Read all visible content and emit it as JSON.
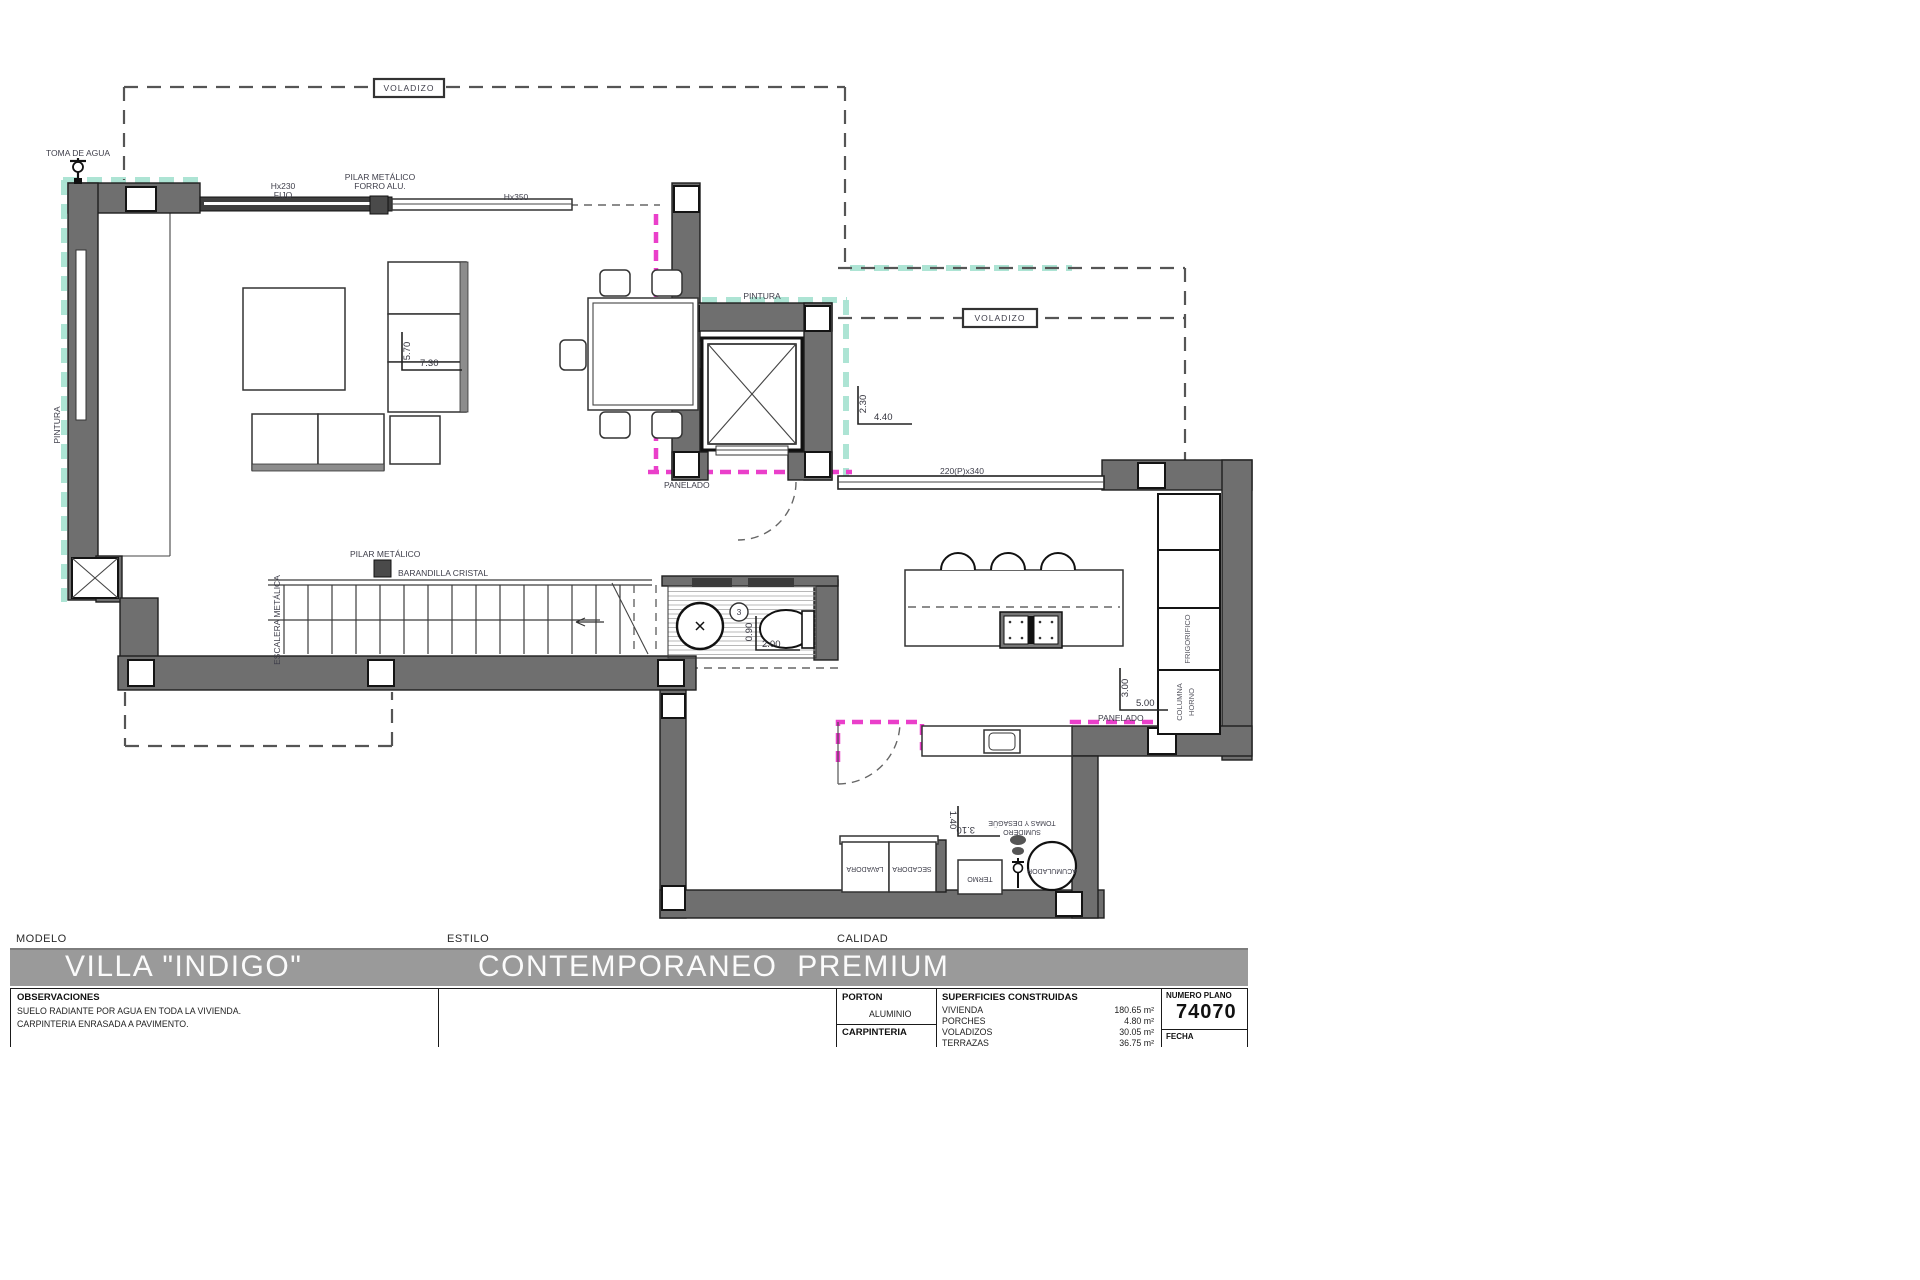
{
  "plan": {
    "annotations": {
      "toma_de_agua": "TOMA DE AGUA",
      "voladizo": "VOLADIZO",
      "hx230": "Hx230",
      "fijo": "FIJO",
      "pilar_metalico": "PILAR METÁLICO",
      "forro_alu": "FORRO ALU.",
      "hx350": "Hx350",
      "pintura": "PINTURA",
      "panelado": "PANELADO",
      "barandilla": "BARANDILLA CRISTAL",
      "escalera": "ESCALERA METÁLICA",
      "frigorifico": "FRIGORIFICO",
      "columna": "COLUMNA",
      "horno": "HORNO",
      "lavadora": "LAVADORA",
      "secadora": "SECADORA",
      "termo": "TERMO",
      "tomas_desague": "TOMAS Y DESAGÜE",
      "sumidero": "SUMIDERO",
      "acumulador": "ACUMULADOR"
    },
    "dimensions": {
      "living_v": "5.70",
      "living_h": "7.30",
      "elevator_v": "2.30",
      "elevator_h": "4.40",
      "kitchen_v": "3.00",
      "kitchen_h": "5.00",
      "bath_v": "0.90",
      "bath_h": "2.00",
      "laundry_v": "1.40",
      "laundry_h": "3.10",
      "window": "220(P)x340",
      "bath_number": "3"
    },
    "colors": {
      "wall": "#6f6f6f",
      "pintura_highlight": "#a9e3d2",
      "panelado_highlight": "#ea3fca",
      "titlebar": "#9a9a9a"
    }
  },
  "titleblock": {
    "modelo_label": "MODELO",
    "modelo": "VILLA \"INDIGO\"",
    "estilo_label": "ESTILO",
    "estilo": "CONTEMPORANEO  PREMIUM",
    "calidad_label": "CALIDAD",
    "observaciones_label": "OBSERVACIONES",
    "observaciones_1": "SUELO RADIANTE POR AGUA EN TODA LA VIVIENDA.",
    "observaciones_2": "CARPINTERIA ENRASADA A PAVIMENTO.",
    "porton_label": "PORTON",
    "porton_value": "ALUMINIO",
    "carpinteria_label": "CARPINTERIA",
    "superficies_label": "SUPERFICIES CONSTRUIDAS",
    "superficies": [
      {
        "name": "VIVIENDA",
        "value": "180.65 m²"
      },
      {
        "name": "PORCHES",
        "value": "4.80 m²"
      },
      {
        "name": "VOLADIZOS",
        "value": "30.05 m²"
      },
      {
        "name": "TERRAZAS",
        "value": "36.75 m²"
      }
    ],
    "numero_plano_label": "NUMERO PLANO",
    "numero_plano": "74070",
    "fecha_label": "FECHA"
  }
}
